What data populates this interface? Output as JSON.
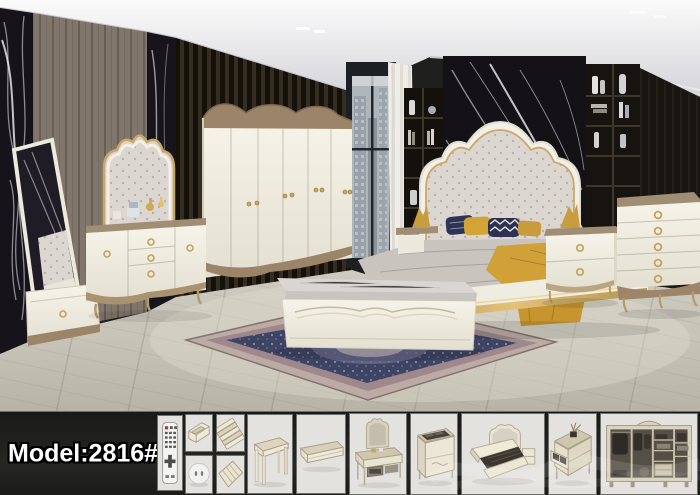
{
  "product": {
    "model_label": "Model:2816#"
  },
  "palette": {
    "accent_gold": "#c3a25f",
    "cream_furniture": "#f2eee0",
    "marble_black": "#16131a",
    "mustard_throw": "#d0a039",
    "navy_pillow": "#2e3356",
    "band_background": "#1b1b1a",
    "thumbnail_background": "#e3e2df",
    "rug_navy": "#3e4464",
    "wood_trim": "#9b8568"
  },
  "scene": {
    "furniture": [
      "cheval-standing-mirror",
      "dresser-with-arched-mirror",
      "six-door-wardrobe",
      "tufted-camelback-bed",
      "storage-bench",
      "nightstand",
      "five-drawer-chest",
      "persian-rug",
      "window-city-view",
      "wall-shelves"
    ]
  },
  "gallery": {
    "thumbnails": [
      {
        "name": "remote-control"
      },
      {
        "name": "bed-frame-part"
      },
      {
        "name": "slat-pack"
      },
      {
        "name": "power-socket"
      },
      {
        "name": "slat-base"
      },
      {
        "name": "dressing-stool"
      },
      {
        "name": "storage-bench"
      },
      {
        "name": "dresser-mirror-open"
      },
      {
        "name": "chest-open-top"
      },
      {
        "name": "lift-storage-bed"
      },
      {
        "name": "nightstand-open-drawer"
      },
      {
        "name": "wardrobe-interior"
      }
    ]
  }
}
